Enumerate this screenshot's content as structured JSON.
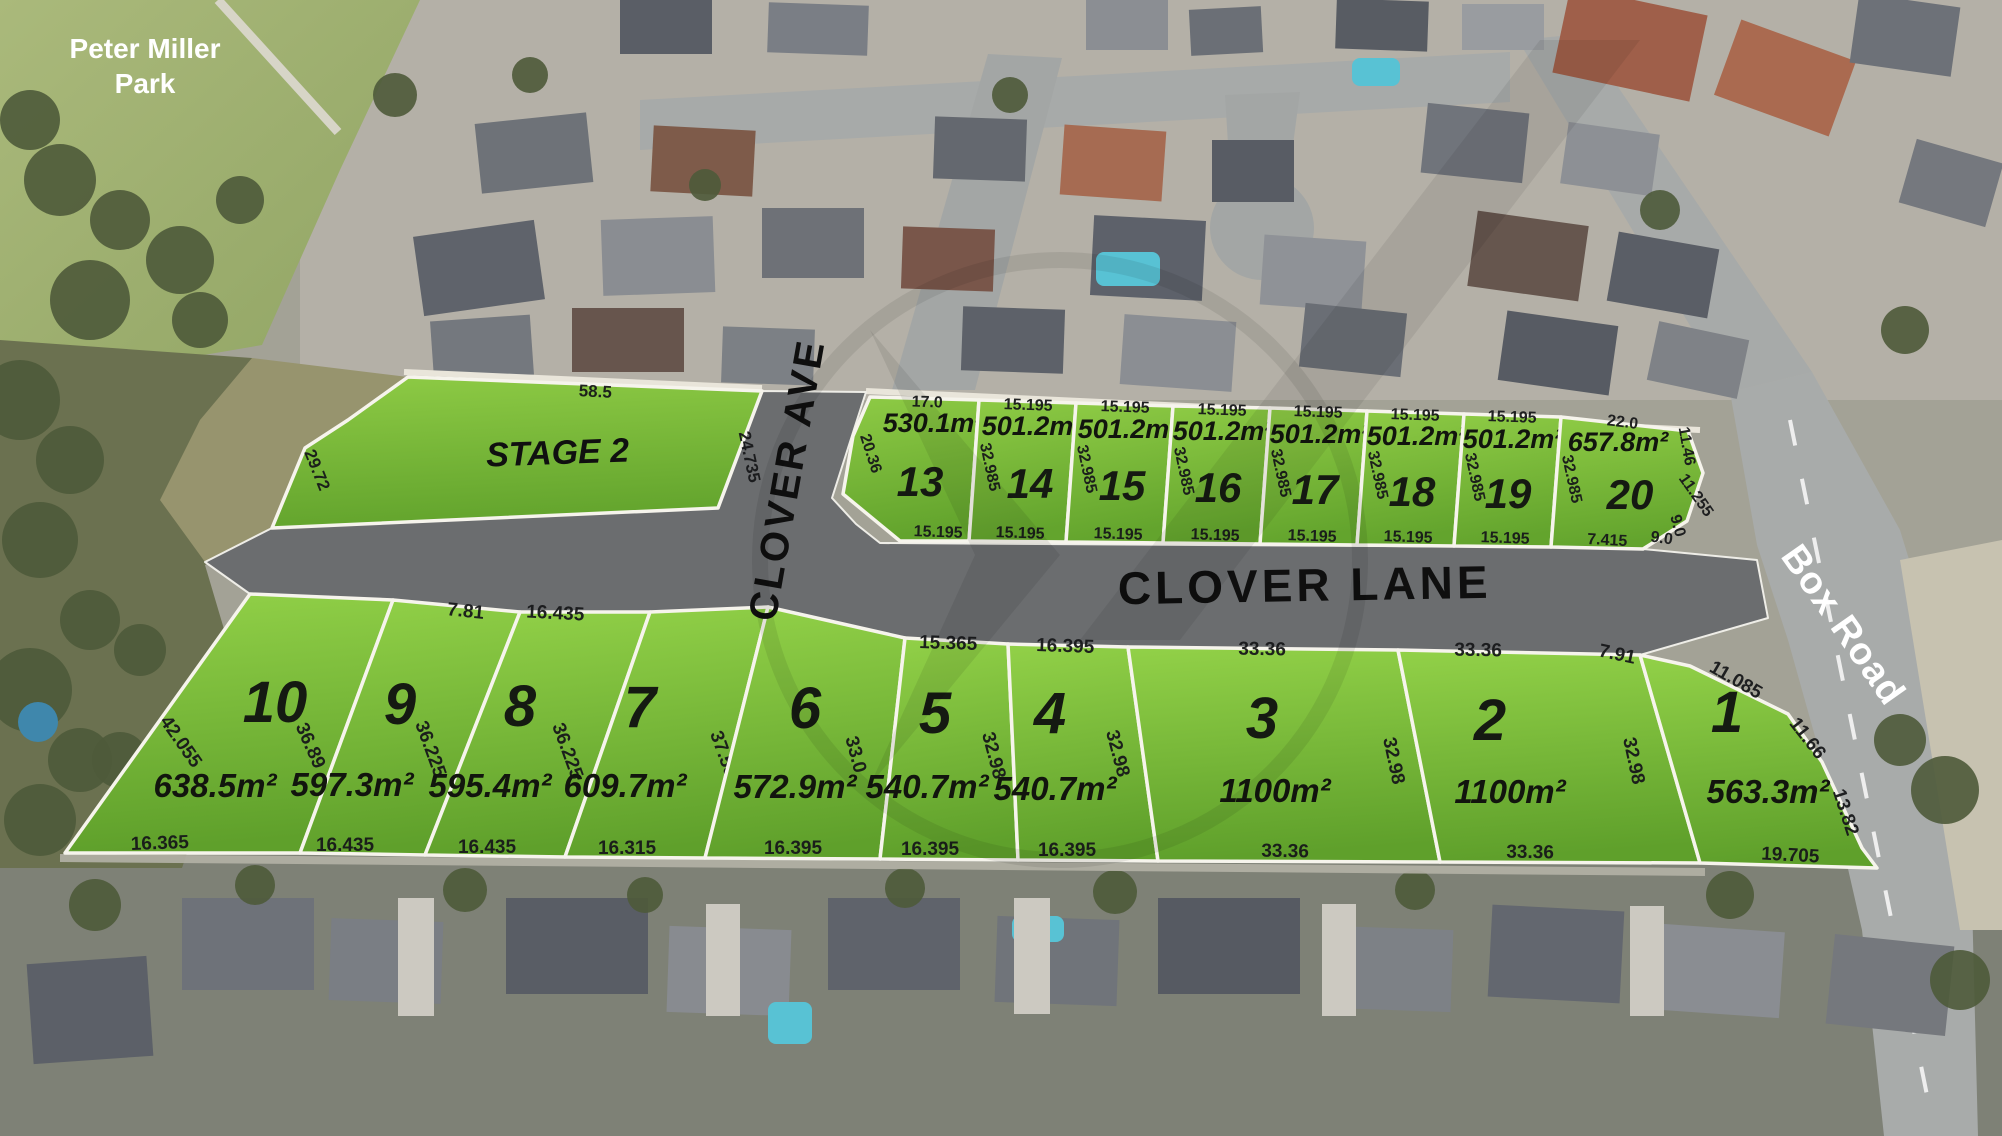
{
  "park": {
    "lines": [
      "Peter Miller",
      "Park"
    ],
    "x": 145,
    "y": 58,
    "line_height": 35,
    "size": 28
  },
  "stage2": {
    "label": "STAGE 2",
    "x": 558,
    "y": 464,
    "rot": -2,
    "size": 34,
    "polygon": [
      [
        408,
        377
      ],
      [
        762,
        391
      ],
      [
        718,
        508
      ],
      [
        272,
        528
      ],
      [
        305,
        448
      ],
      [
        348,
        420
      ]
    ],
    "dims": [
      {
        "t": "58.5",
        "x": 595,
        "y": 397,
        "r": 3
      },
      {
        "t": "24.735",
        "x": 744,
        "y": 458,
        "r": 78
      },
      {
        "t": "29.72",
        "x": 312,
        "y": 472,
        "r": 68
      }
    ]
  },
  "streets": [
    {
      "id": "clover-ave",
      "name": "CLOVER AVE",
      "x": 800,
      "y": 482,
      "rot": -80,
      "size": 40,
      "spacing": 3,
      "white": false
    },
    {
      "id": "clover-lane",
      "name": "CLOVER LANE",
      "x": 1305,
      "y": 601,
      "rot": -1,
      "size": 46,
      "spacing": 4,
      "white": false
    },
    {
      "id": "box-road",
      "name": "Box Road",
      "x": 1833,
      "y": 632,
      "rot": 55,
      "size": 38,
      "spacing": 1,
      "white": true
    }
  ],
  "road_overlay_polygon": [
    [
      205,
      562
    ],
    [
      272,
      528
    ],
    [
      718,
      508
    ],
    [
      762,
      391
    ],
    [
      866,
      392
    ],
    [
      832,
      498
    ],
    [
      856,
      524
    ],
    [
      880,
      543
    ],
    [
      1200,
      545
    ],
    [
      1551,
      547
    ],
    [
      1643,
      549
    ],
    [
      1757,
      560
    ],
    [
      1768,
      618
    ],
    [
      1640,
      655
    ],
    [
      1398,
      650
    ],
    [
      1128,
      647
    ],
    [
      1008,
      644
    ],
    [
      905,
      638
    ],
    [
      768,
      607
    ],
    [
      650,
      612
    ],
    [
      520,
      612
    ],
    [
      393,
      600
    ],
    [
      250,
      594
    ]
  ],
  "lots": [
    {
      "number": "13",
      "area": "530.1m²",
      "row": "top",
      "polygon": [
        [
          870,
          397
        ],
        [
          979,
          400
        ],
        [
          969,
          541
        ],
        [
          900,
          541
        ],
        [
          843,
          494
        ],
        [
          853,
          436
        ]
      ],
      "num": [
        920,
        496
      ],
      "area_pos": [
        933,
        432
      ],
      "dims": [
        {
          "t": "17.0",
          "x": 927,
          "y": 407,
          "r": 2
        },
        {
          "t": "20.36",
          "x": 866,
          "y": 455,
          "r": 72
        },
        {
          "t": "15.195",
          "x": 938,
          "y": 537,
          "r": 2
        }
      ]
    },
    {
      "number": "14",
      "area": "501.2m²",
      "row": "top",
      "polygon": [
        [
          979,
          400
        ],
        [
          1076,
          403
        ],
        [
          1066,
          542
        ],
        [
          969,
          541
        ]
      ],
      "num": [
        1030,
        498
      ],
      "area_pos": [
        1032,
        435
      ],
      "dims": [
        {
          "t": "15.195",
          "x": 1028,
          "y": 410,
          "r": 2
        },
        {
          "t": "32.985",
          "x": 985,
          "y": 468,
          "r": 78
        },
        {
          "t": "15.195",
          "x": 1020,
          "y": 538,
          "r": 2
        }
      ]
    },
    {
      "number": "15",
      "area": "501.2m²",
      "row": "top",
      "polygon": [
        [
          1076,
          403
        ],
        [
          1173,
          406
        ],
        [
          1163,
          543
        ],
        [
          1066,
          542
        ]
      ],
      "num": [
        1122,
        500
      ],
      "area_pos": [
        1128,
        438
      ],
      "dims": [
        {
          "t": "15.195",
          "x": 1125,
          "y": 412,
          "r": 2
        },
        {
          "t": "32.985",
          "x": 1082,
          "y": 470,
          "r": 78
        },
        {
          "t": "15.195",
          "x": 1118,
          "y": 539,
          "r": 2
        }
      ]
    },
    {
      "number": "16",
      "area": "501.2m²",
      "row": "top",
      "polygon": [
        [
          1173,
          406
        ],
        [
          1270,
          408
        ],
        [
          1260,
          544
        ],
        [
          1163,
          543
        ]
      ],
      "num": [
        1218,
        502
      ],
      "area_pos": [
        1223,
        440
      ],
      "dims": [
        {
          "t": "15.195",
          "x": 1222,
          "y": 415,
          "r": 2
        },
        {
          "t": "32.985",
          "x": 1179,
          "y": 472,
          "r": 78
        },
        {
          "t": "15.195",
          "x": 1215,
          "y": 540,
          "r": 2
        }
      ]
    },
    {
      "number": "17",
      "area": "501.2m²",
      "row": "top",
      "polygon": [
        [
          1270,
          408
        ],
        [
          1367,
          411
        ],
        [
          1357,
          545
        ],
        [
          1260,
          544
        ]
      ],
      "num": [
        1315,
        504
      ],
      "area_pos": [
        1320,
        443
      ],
      "dims": [
        {
          "t": "15.195",
          "x": 1318,
          "y": 417,
          "r": 2
        },
        {
          "t": "32.985",
          "x": 1276,
          "y": 474,
          "r": 78
        },
        {
          "t": "15.195",
          "x": 1312,
          "y": 541,
          "r": 2
        }
      ]
    },
    {
      "number": "18",
      "area": "501.2m²",
      "row": "top",
      "polygon": [
        [
          1367,
          411
        ],
        [
          1464,
          414
        ],
        [
          1454,
          546
        ],
        [
          1357,
          545
        ]
      ],
      "num": [
        1412,
        506
      ],
      "area_pos": [
        1417,
        445
      ],
      "dims": [
        {
          "t": "15.195",
          "x": 1415,
          "y": 420,
          "r": 2
        },
        {
          "t": "32.985",
          "x": 1373,
          "y": 476,
          "r": 78
        },
        {
          "t": "15.195",
          "x": 1408,
          "y": 542,
          "r": 2
        }
      ]
    },
    {
      "number": "19",
      "area": "501.2m²",
      "row": "top",
      "polygon": [
        [
          1464,
          414
        ],
        [
          1561,
          417
        ],
        [
          1551,
          547
        ],
        [
          1454,
          546
        ]
      ],
      "num": [
        1508,
        508
      ],
      "area_pos": [
        1513,
        448
      ],
      "dims": [
        {
          "t": "15.195",
          "x": 1512,
          "y": 422,
          "r": 2
        },
        {
          "t": "32.985",
          "x": 1470,
          "y": 478,
          "r": 78
        },
        {
          "t": "15.195",
          "x": 1505,
          "y": 543,
          "r": 2
        }
      ]
    },
    {
      "number": "20",
      "area": "657.8m²",
      "row": "top",
      "polygon": [
        [
          1561,
          417
        ],
        [
          1688,
          431
        ],
        [
          1703,
          473
        ],
        [
          1687,
          521
        ],
        [
          1643,
          549
        ],
        [
          1551,
          547
        ]
      ],
      "num": [
        1630,
        509
      ],
      "area_pos": [
        1618,
        451
      ],
      "dims": [
        {
          "t": "22.0",
          "x": 1622,
          "y": 427,
          "r": 7
        },
        {
          "t": "32.985",
          "x": 1567,
          "y": 480,
          "r": 78
        },
        {
          "t": "11.46",
          "x": 1682,
          "y": 447,
          "r": 80
        },
        {
          "t": "11.255",
          "x": 1692,
          "y": 498,
          "r": 55
        },
        {
          "t": "9.0",
          "x": 1673,
          "y": 527,
          "r": 75
        },
        {
          "t": "9.0",
          "x": 1661,
          "y": 543,
          "r": 8
        },
        {
          "t": "7.415",
          "x": 1607,
          "y": 545,
          "r": 3
        }
      ]
    },
    {
      "number": "10",
      "area": "638.5m²",
      "row": "bottom",
      "polygon": [
        [
          250,
          594
        ],
        [
          393,
          600
        ],
        [
          300,
          853
        ],
        [
          65,
          853
        ]
      ],
      "num": [
        275,
        722
      ],
      "area_pos": [
        215,
        797
      ],
      "dims": [
        {
          "t": "42.055",
          "x": 176,
          "y": 745,
          "r": 55
        },
        {
          "t": "36.89",
          "x": 305,
          "y": 748,
          "r": 66
        },
        {
          "t": "16.365",
          "x": 160,
          "y": 849,
          "r": -2
        }
      ]
    },
    {
      "number": "9",
      "area": "597.3m²",
      "row": "bottom",
      "polygon": [
        [
          393,
          600
        ],
        [
          520,
          612
        ],
        [
          425,
          855
        ],
        [
          300,
          853
        ]
      ],
      "num": [
        400,
        724
      ],
      "area_pos": [
        352,
        796
      ],
      "dims": [
        {
          "t": "7.81",
          "x": 465,
          "y": 617,
          "r": 6
        },
        {
          "t": "36.225",
          "x": 425,
          "y": 751,
          "r": 70
        },
        {
          "t": "16.435",
          "x": 345,
          "y": 851,
          "r": 0
        }
      ]
    },
    {
      "number": "8",
      "area": "595.4m²",
      "row": "bottom",
      "polygon": [
        [
          520,
          612
        ],
        [
          650,
          612
        ],
        [
          565,
          857
        ],
        [
          425,
          855
        ]
      ],
      "num": [
        520,
        726
      ],
      "area_pos": [
        490,
        797
      ],
      "dims": [
        {
          "t": "16.435",
          "x": 555,
          "y": 619,
          "r": 3
        },
        {
          "t": "36.225",
          "x": 562,
          "y": 753,
          "r": 70
        },
        {
          "t": "16.435",
          "x": 487,
          "y": 853,
          "r": 0
        }
      ]
    },
    {
      "number": "7",
      "area": "609.7m²",
      "row": "bottom",
      "polygon": [
        [
          650,
          612
        ],
        [
          768,
          607
        ],
        [
          705,
          858
        ],
        [
          565,
          857
        ]
      ],
      "num": [
        640,
        727
      ],
      "area_pos": [
        625,
        797
      ],
      "dims": [
        {
          "t": "37.55",
          "x": 718,
          "y": 756,
          "r": 70
        },
        {
          "t": "16.315",
          "x": 627,
          "y": 854,
          "r": 0
        }
      ]
    },
    {
      "number": "6",
      "area": "572.9m²",
      "row": "bottom",
      "polygon": [
        [
          768,
          607
        ],
        [
          905,
          638
        ],
        [
          880,
          859
        ],
        [
          705,
          858
        ]
      ],
      "num": [
        805,
        728
      ],
      "area_pos": [
        795,
        798
      ],
      "dims": [
        {
          "t": "33.0",
          "x": 850,
          "y": 756,
          "r": 75
        },
        {
          "t": "16.395",
          "x": 793,
          "y": 854,
          "r": 0
        }
      ]
    },
    {
      "number": "5",
      "area": "540.7m²",
      "row": "bottom",
      "polygon": [
        [
          905,
          638
        ],
        [
          1008,
          644
        ],
        [
          1018,
          860
        ],
        [
          880,
          859
        ]
      ],
      "num": [
        935,
        733
      ],
      "area_pos": [
        927,
        798
      ],
      "dims": [
        {
          "t": "15.365",
          "x": 948,
          "y": 649,
          "r": 2
        },
        {
          "t": "32.98",
          "x": 988,
          "y": 757,
          "r": 75
        },
        {
          "t": "16.395",
          "x": 930,
          "y": 855,
          "r": 0
        }
      ]
    },
    {
      "number": "4",
      "area": "540.7m²",
      "row": "bottom",
      "polygon": [
        [
          1008,
          644
        ],
        [
          1128,
          647
        ],
        [
          1158,
          861
        ],
        [
          1018,
          860
        ]
      ],
      "num": [
        1050,
        733
      ],
      "area_pos": [
        1055,
        800
      ],
      "dims": [
        {
          "t": "16.395",
          "x": 1065,
          "y": 652,
          "r": 2
        },
        {
          "t": "32.98",
          "x": 1112,
          "y": 755,
          "r": 75
        },
        {
          "t": "16.395",
          "x": 1067,
          "y": 856,
          "r": 0
        }
      ]
    },
    {
      "number": "3",
      "area": "1100m²",
      "row": "bottom",
      "polygon": [
        [
          1128,
          647
        ],
        [
          1398,
          650
        ],
        [
          1440,
          862
        ],
        [
          1158,
          861
        ]
      ],
      "num": [
        1262,
        738
      ],
      "area_pos": [
        1275,
        802
      ],
      "dims": [
        {
          "t": "33.36",
          "x": 1262,
          "y": 655,
          "r": 1
        },
        {
          "t": "32.98",
          "x": 1388,
          "y": 762,
          "r": 78
        },
        {
          "t": "33.36",
          "x": 1285,
          "y": 857,
          "r": 1
        }
      ]
    },
    {
      "number": "2",
      "area": "1100m²",
      "row": "bottom",
      "polygon": [
        [
          1398,
          650
        ],
        [
          1640,
          655
        ],
        [
          1700,
          863
        ],
        [
          1440,
          862
        ]
      ],
      "num": [
        1490,
        740
      ],
      "area_pos": [
        1510,
        803
      ],
      "dims": [
        {
          "t": "33.36",
          "x": 1478,
          "y": 656,
          "r": 1
        },
        {
          "t": "32.98",
          "x": 1628,
          "y": 762,
          "r": 78
        },
        {
          "t": "33.36",
          "x": 1530,
          "y": 858,
          "r": 1
        }
      ]
    },
    {
      "number": "1",
      "area": "563.3m²",
      "row": "bottom",
      "polygon": [
        [
          1640,
          655
        ],
        [
          1690,
          666
        ],
        [
          1788,
          714
        ],
        [
          1822,
          762
        ],
        [
          1862,
          848
        ],
        [
          1877,
          868
        ],
        [
          1700,
          863
        ]
      ],
      "num": [
        1727,
        732
      ],
      "area_pos": [
        1768,
        803
      ],
      "dims": [
        {
          "t": "7.91",
          "x": 1616,
          "y": 660,
          "r": 12
        },
        {
          "t": "11.085",
          "x": 1733,
          "y": 685,
          "r": 30
        },
        {
          "t": "11.66",
          "x": 1803,
          "y": 742,
          "r": 52
        },
        {
          "t": "13.82",
          "x": 1840,
          "y": 814,
          "r": 72
        },
        {
          "t": "19.705",
          "x": 1790,
          "y": 861,
          "r": 3
        }
      ]
    }
  ],
  "colors": {
    "grass_light": "#8cc944",
    "grass_dark": "#63a42d",
    "road_overlay": "#6b6d6f",
    "photo_road": "#a5a8a7",
    "park_green": "#a6b676",
    "bush": "#6b7150"
  }
}
